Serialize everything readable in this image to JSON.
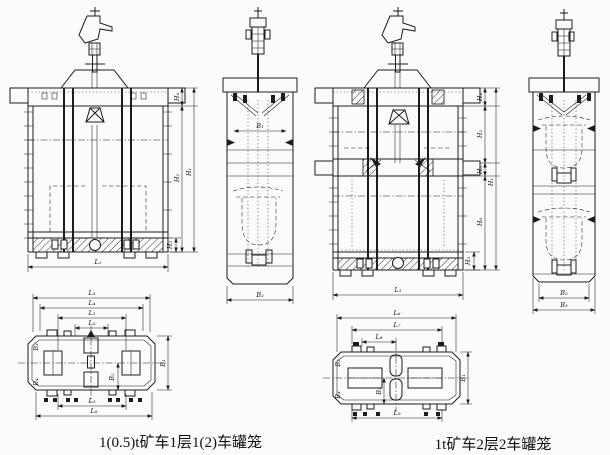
{
  "sheet": {
    "paper_color": "#fbfbf9",
    "ink_color": "#1c1c1c"
  },
  "left_figure": {
    "caption": "1(0.5)t矿车1层1(2)车罐笼",
    "front_dims": {
      "H1": "H₁",
      "H2": "H₂",
      "H3": "H₃",
      "H4": "H₄",
      "L1": "L₁"
    },
    "side_dims": {
      "B1": "B₁",
      "B2": "B₂"
    },
    "plan_dims": {
      "top": [
        "L₃",
        "L₄",
        "L₁",
        "L₂"
      ],
      "bottom": [
        "L₅",
        "L₆"
      ],
      "B1": "B₁",
      "B2": "B₂",
      "B3": "B₃",
      "B4": "B₄"
    }
  },
  "right_figure": {
    "caption": "1t矿车2层2车罐笼",
    "front_dims": {
      "H1": "H₁",
      "H2": "H₂",
      "H3": "H₃",
      "H4": "H₄",
      "H5": "H₅",
      "H6": "H₆",
      "L1": "L₁"
    },
    "side_dims": {
      "B2": "B₂",
      "B3": "B₃"
    },
    "plan_dims": {
      "top": [
        "L₆",
        "L₇",
        "L₈"
      ],
      "bottom": [
        "L₉"
      ],
      "B1": "B₁",
      "B2": "B₂",
      "B3": "B₃",
      "B4": "B₄"
    }
  }
}
